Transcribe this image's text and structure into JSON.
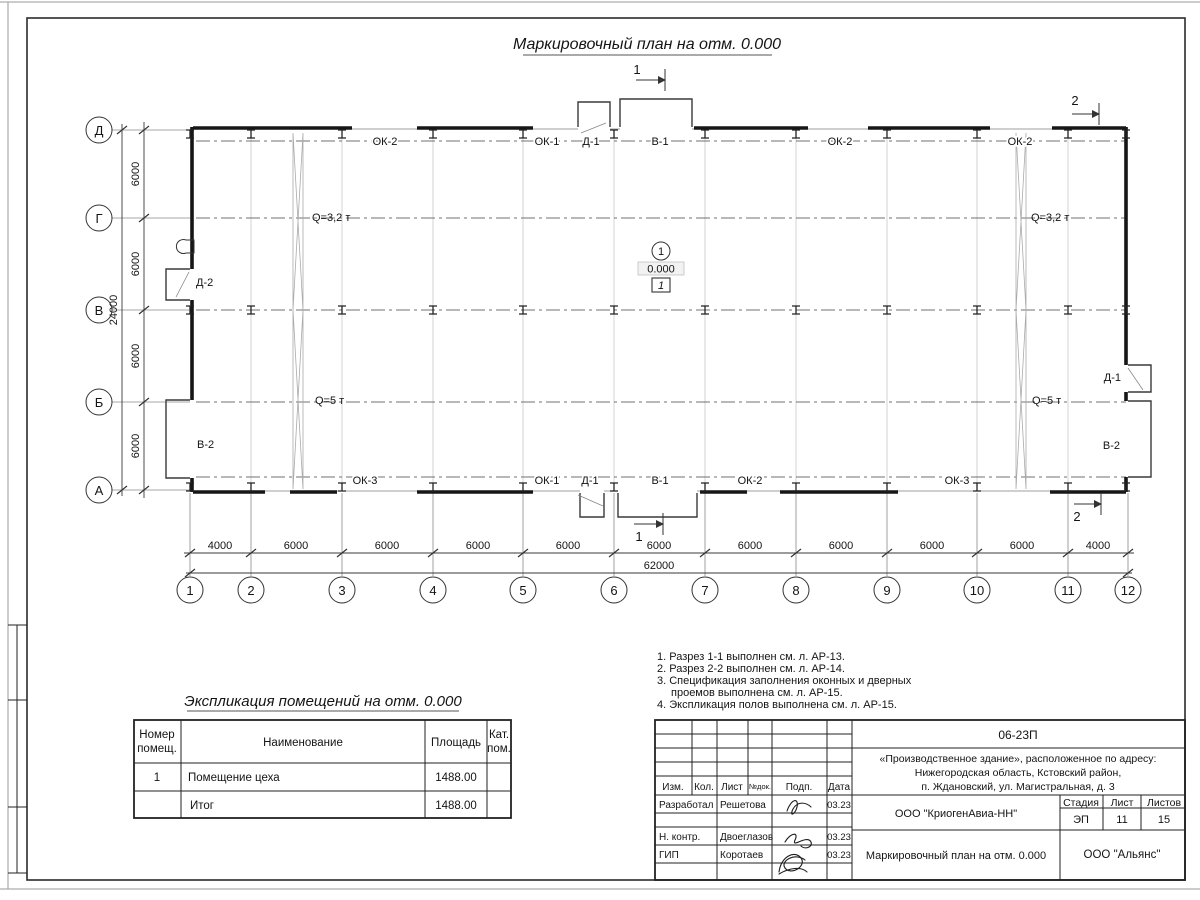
{
  "sheet": {
    "title": "Маркировочный план на отм. 0.000"
  },
  "plan": {
    "grid_rows": [
      "Д",
      "Г",
      "В",
      "Б",
      "А"
    ],
    "grid_cols": [
      "1",
      "2",
      "3",
      "4",
      "5",
      "6",
      "7",
      "8",
      "9",
      "10",
      "11",
      "12"
    ],
    "dims_left": [
      "6000",
      "6000",
      "6000",
      "6000"
    ],
    "dims_left_total": "24000",
    "dims_bottom": [
      "4000",
      "6000",
      "6000",
      "6000",
      "6000",
      "6000",
      "6000",
      "6000",
      "6000",
      "6000",
      "4000"
    ],
    "dims_bottom_total": "62000",
    "labels_top": [
      "ОК-2",
      "ОК-1",
      "Д-1",
      "В-1",
      "ОК-2",
      "ОК-2"
    ],
    "labels_bottom": [
      "ОК-3",
      "ОК-1",
      "Д-1",
      "В-1",
      "ОК-2",
      "ОК-3"
    ],
    "label_left_door": "Д-2",
    "label_left_gate": "В-2",
    "label_right_door": "Д-1",
    "label_right_gate": "В-2",
    "crane_q32": "Q=3,2 т",
    "crane_q5": "Q=5 т",
    "section_1": "1",
    "section_2": "2",
    "room_marker": {
      "number": "1",
      "elevation": "0.000",
      "zone": "1"
    }
  },
  "notes": {
    "lines": [
      "1. Разрез 1-1 выполнен см. л. АР-13.",
      "2. Разрез 2-2 выполнен см. л. АР-14.",
      "3. Спецификация заполнения оконных и дверных",
      "проемов выполнена см. л. АР-15.",
      "4. Экспликация полов выполнена см. л. АР-15."
    ]
  },
  "room_table": {
    "title": "Экспликация помещений на отм. 0.000",
    "col_number_1": "Номер",
    "col_number_2": "помещ.",
    "col_name": "Наименование",
    "col_area": "Площадь",
    "col_cat_1": "Кат.",
    "col_cat_2": "пом.",
    "rows": [
      {
        "num": "1",
        "name": "Помещение цеха",
        "area": "1488.00",
        "cat": ""
      },
      {
        "num": "",
        "name": "Итог",
        "area": "1488.00",
        "cat": ""
      }
    ]
  },
  "title_block": {
    "doc_number": "06-23П",
    "object_line1": "«Производственное здание», расположенное по адресу:",
    "object_line2": "Нижегородская область, Кстовский район,",
    "object_line3": "п. Ждановский, ул. Магистральная, д. 3",
    "rev_headers": [
      "Изм.",
      "Кол.",
      "Лист",
      "№док.",
      "Подп.",
      "Дата"
    ],
    "roles": [
      {
        "role": "Разработал",
        "name": "Решетова",
        "date": "03.23"
      },
      {
        "role": "Н. контр.",
        "name": "Двоеглазов",
        "date": "03.23"
      },
      {
        "role": "ГИП",
        "name": "Коротаев",
        "date": "03.23"
      }
    ],
    "company": "ООО \"КриогенАвиа-НН\"",
    "stage_label": "Стадия",
    "sheet_label": "Лист",
    "sheets_label": "Листов",
    "stage": "ЭП",
    "sheet": "11",
    "sheets": "15",
    "drawing_title": "Маркировочный план на отм. 0.000",
    "org": "ООО \"Альянс\""
  }
}
